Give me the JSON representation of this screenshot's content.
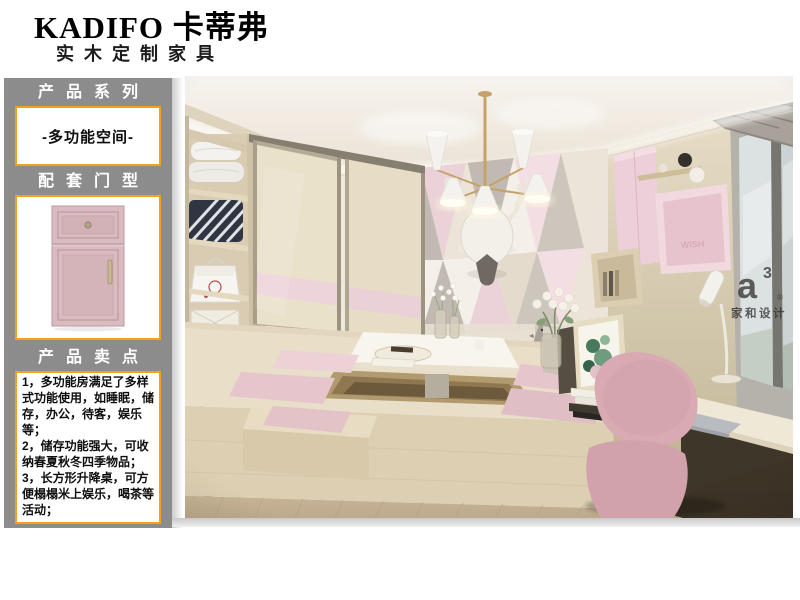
{
  "brand": {
    "logo": "KADIFO 卡蒂弗",
    "tagline": "实木定制家具"
  },
  "sidebar": {
    "series_header": "产品系列",
    "series_value": "-多功能空间-",
    "door_header": "配套门型",
    "selling_header": "产品卖点",
    "selling_points": [
      "1，多功能房满足了多样式功能使用，如睡眠，储存，办公，待客，娱乐等；",
      "2，储存功能强大，可收纳春夏秋冬四季物品；",
      "3，长方形升降桌，可方便榻榻米上娱乐，喝茶等活动；"
    ]
  },
  "photo": {
    "watermark_a": "a",
    "watermark_sup": "3",
    "watermark_reg": "®",
    "watermark_name": "家和设计",
    "shelf_text": "WISH"
  },
  "colors": {
    "accent": "#efa21a",
    "sidebar-gray": "#8c8c8c",
    "brand-pink": "#dcbfc4",
    "text-dark": "#111111"
  }
}
